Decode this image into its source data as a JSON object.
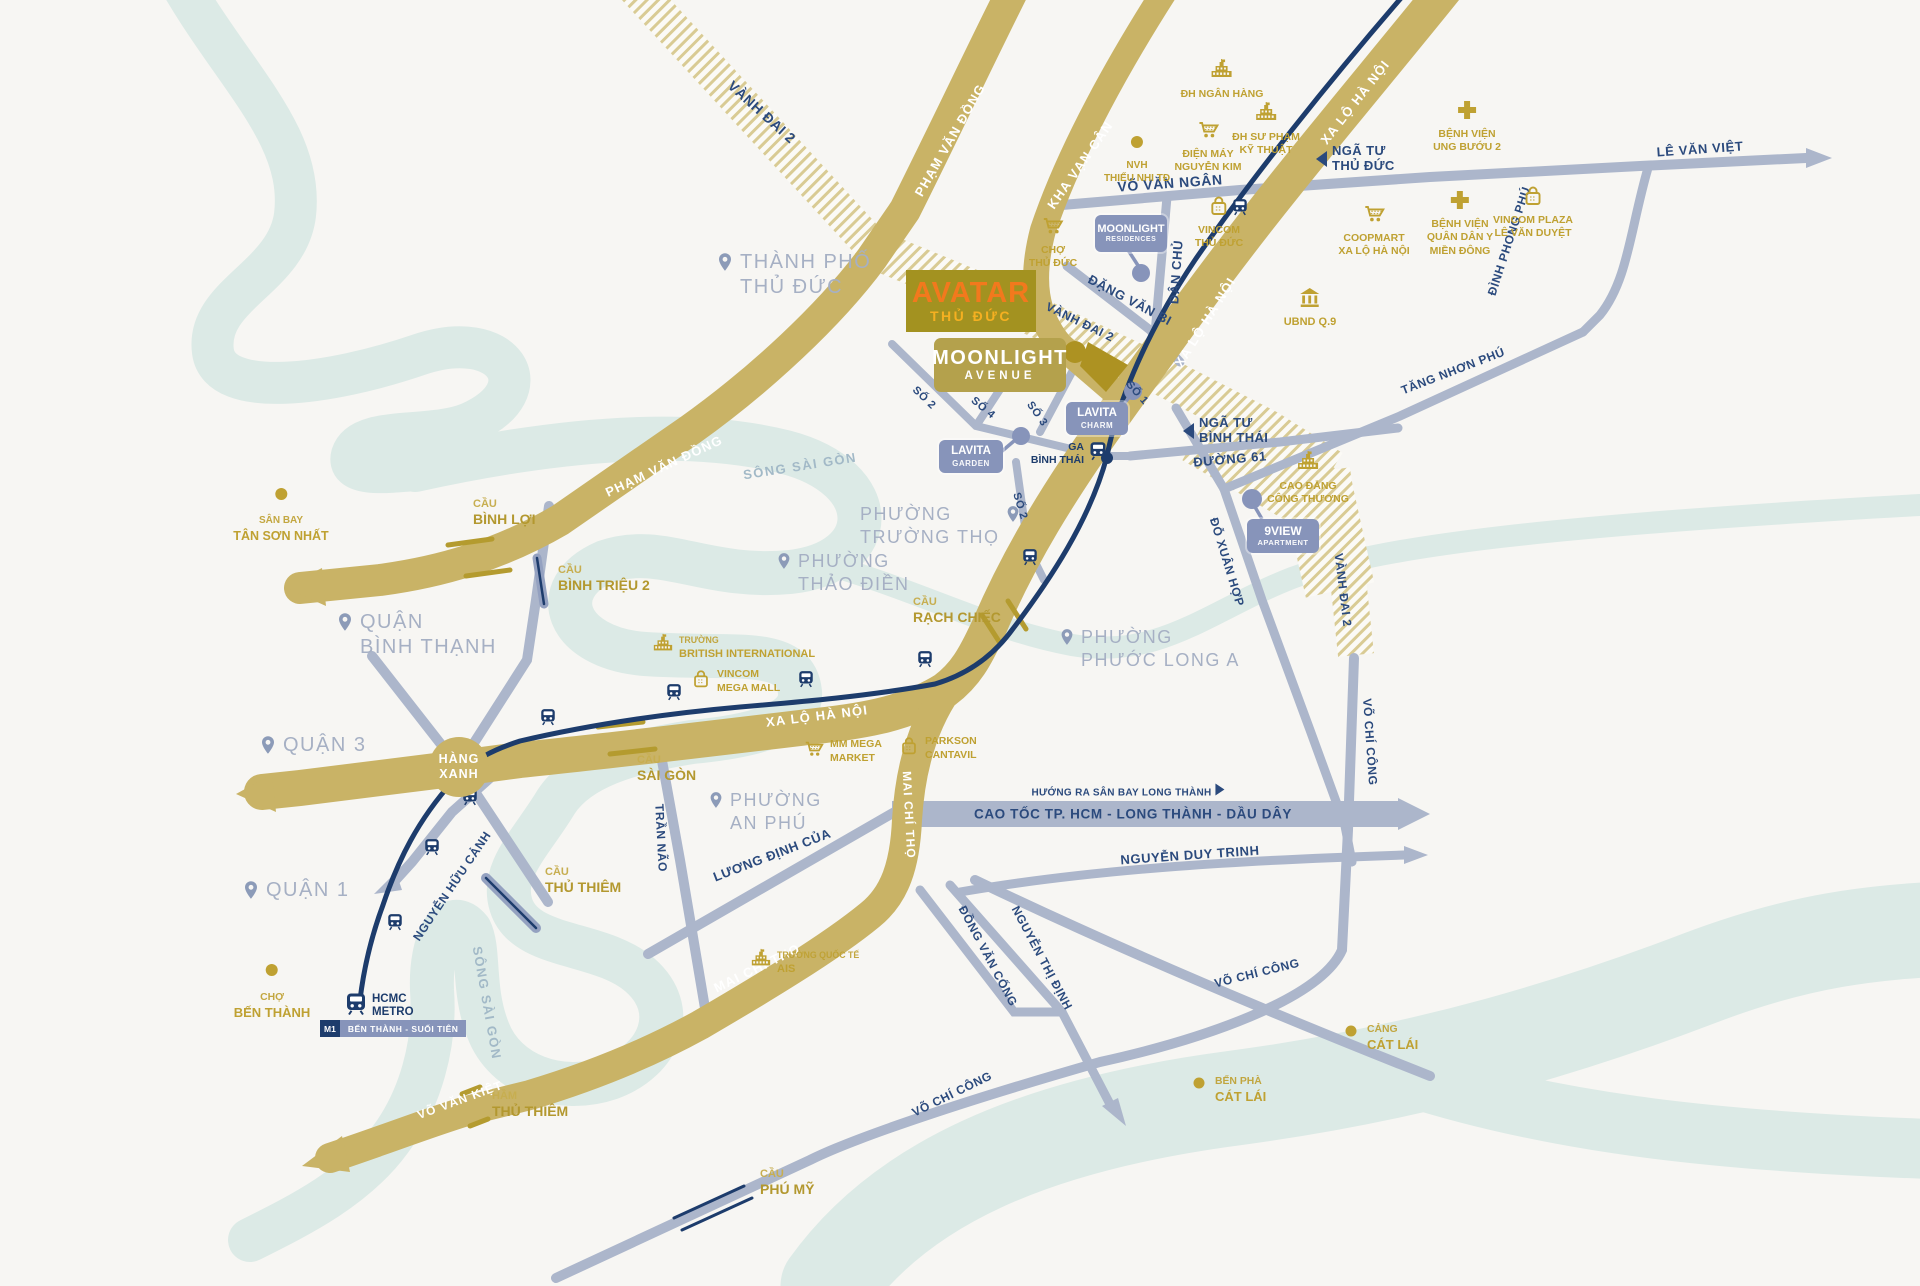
{
  "project": {
    "badge_line1": "AVATAR",
    "badge_line2": "THỦ ĐỨC",
    "avenue_line1": "MOONLIGHT",
    "avenue_line2": "AVENUE"
  },
  "hang_xanh": {
    "line1": "HÀNG",
    "line2": "XANH"
  },
  "metro": {
    "operator_line1": "HCMC",
    "operator_line2": "METRO",
    "line_badge": "M1",
    "line_name": "BẾN THÀNH - SUỐI TIÊN",
    "ga_line1": "GA",
    "ga_line2": "BÌNH THÁI"
  },
  "colors": {
    "bg": "#F7F6F3",
    "gold_road": "#C9B366",
    "gray_road": "#ACB6CB",
    "navy": "#1D3C6C",
    "street_label": "#2B4A7D",
    "river": "#DCEAE6",
    "poi_gold": "#BFA132",
    "district": "#A6B0C4",
    "pin": "#8C9BB8",
    "badge_blue": "#8794BA",
    "hatch": "#D9CB94",
    "avatar_bg": "#A39220",
    "avatar_orange": "#F2791D",
    "avatar_yellow": "#F5B021",
    "moonlight_bg": "#B4A14C"
  },
  "road_labels": [
    {
      "id": "vanh-dai-2-nw",
      "t": "VÀNH ĐAI 2",
      "x": 762,
      "y": 112,
      "r": 42,
      "s": "street",
      "fs": 14
    },
    {
      "id": "pham-van-dong-n",
      "t": "PHẠM VĂN ĐỒNG",
      "x": 950,
      "y": 140,
      "r": -60,
      "s": "onroad",
      "fs": 13
    },
    {
      "id": "kha-van-can",
      "t": "KHA VẠN CÂN",
      "x": 1080,
      "y": 165,
      "r": -55,
      "s": "onroad",
      "fs": 13
    },
    {
      "id": "xa-lo-ha-noi-n",
      "t": "XA LỘ HÀ NỘI",
      "x": 1355,
      "y": 102,
      "r": -52,
      "s": "onroad",
      "fs": 13
    },
    {
      "id": "vo-van-ngan",
      "t": "VÕ VĂN NGÂN",
      "x": 1170,
      "y": 183,
      "r": -4,
      "s": "street",
      "fs": 14
    },
    {
      "id": "le-van-viet",
      "t": "LÊ VĂN VIỆT",
      "x": 1700,
      "y": 149,
      "r": -4,
      "s": "street",
      "fs": 13
    },
    {
      "id": "dinh-phong-phu",
      "t": "ĐÌNH PHONG PHÚ",
      "x": 1509,
      "y": 241,
      "r": -72,
      "s": "street",
      "fs": 12
    },
    {
      "id": "tang-nhon-phu",
      "t": "TĂNG NHƠN PHÚ",
      "x": 1453,
      "y": 371,
      "r": -21,
      "s": "street",
      "fs": 12
    },
    {
      "id": "dang-van-bi",
      "t": "ĐẶNG VĂN BI",
      "x": 1130,
      "y": 300,
      "r": 28,
      "s": "street",
      "fs": 13
    },
    {
      "id": "dan-chu",
      "t": "DÂN CHỦ",
      "x": 1176,
      "y": 272,
      "r": -86,
      "s": "street",
      "fs": 13
    },
    {
      "id": "vanh-dai-2-c",
      "t": "VÀNH ĐAI 2",
      "x": 1080,
      "y": 322,
      "r": 26,
      "s": "street",
      "fs": 12
    },
    {
      "id": "xa-lo-ha-noi-c",
      "t": "XA LỘ HÀ NỘI",
      "x": 1205,
      "y": 322,
      "r": -58,
      "s": "onroad",
      "fs": 13
    },
    {
      "id": "so-2-a",
      "t": "SỐ 2",
      "x": 924,
      "y": 398,
      "r": 44,
      "s": "street",
      "fs": 11
    },
    {
      "id": "so-4",
      "t": "SỐ 4",
      "x": 983,
      "y": 408,
      "r": 40,
      "s": "street",
      "fs": 11
    },
    {
      "id": "so-3",
      "t": "SỐ 3",
      "x": 1037,
      "y": 414,
      "r": 55,
      "s": "street",
      "fs": 11
    },
    {
      "id": "so-1",
      "t": "SỐ 1",
      "x": 1137,
      "y": 393,
      "r": 48,
      "s": "street",
      "fs": 11
    },
    {
      "id": "so-2-b",
      "t": "SỐ 2",
      "x": 1020,
      "y": 506,
      "r": 73,
      "s": "street",
      "fs": 11
    },
    {
      "id": "duong-61",
      "t": "ĐƯỜNG 61",
      "x": 1230,
      "y": 459,
      "r": -5,
      "s": "street",
      "fs": 13
    },
    {
      "id": "do-xuan-hop",
      "t": "ĐỖ XUÂN HỢP",
      "x": 1227,
      "y": 562,
      "r": 73,
      "s": "street",
      "fs": 12
    },
    {
      "id": "vanh-dai-2-e",
      "t": "VÀNH ĐAI 2",
      "x": 1343,
      "y": 590,
      "r": 83,
      "s": "street",
      "fs": 12
    },
    {
      "id": "vo-chi-cong-v",
      "t": "VÕ CHÍ CÔNG",
      "x": 1370,
      "y": 742,
      "r": 86,
      "s": "street",
      "fs": 12
    },
    {
      "id": "tran-nao",
      "t": "TRẦN NÃO",
      "x": 661,
      "y": 838,
      "r": 87,
      "s": "street",
      "fs": 12
    },
    {
      "id": "luong-dinh-cua",
      "t": "LƯƠNG ĐỊNH CỦA",
      "x": 772,
      "y": 855,
      "r": -21,
      "s": "street",
      "fs": 13
    },
    {
      "id": "nguyen-huu-canh",
      "t": "NGUYỄN HỮU CẢNH",
      "x": 452,
      "y": 886,
      "r": -56,
      "s": "street",
      "fs": 12
    },
    {
      "id": "mai-chi-tho-v",
      "t": "MAI CHÍ THỌ",
      "x": 909,
      "y": 815,
      "r": 87,
      "s": "onroad",
      "fs": 12
    },
    {
      "id": "mai-chi-tho-sw",
      "t": "MAI CHÍ THỌ",
      "x": 757,
      "y": 968,
      "r": -26,
      "s": "onroad",
      "fs": 13
    },
    {
      "id": "xa-lo-ha-noi-s",
      "t": "XA LỘ HÀ NỘI",
      "x": 817,
      "y": 716,
      "r": -7,
      "s": "onroad",
      "fs": 13
    },
    {
      "id": "song-sai-gon-n",
      "t": "SÔNG SÀI GÒN",
      "x": 800,
      "y": 466,
      "r": -9,
      "s": "river",
      "fs": 13
    },
    {
      "id": "song-sai-gon-s",
      "t": "SÔNG SÀI GÒN",
      "x": 487,
      "y": 1003,
      "r": 80,
      "s": "river",
      "fs": 13
    },
    {
      "id": "nguyen-duy-trinh",
      "t": "NGUYỄN DUY TRINH",
      "x": 1190,
      "y": 855,
      "r": -4,
      "s": "street",
      "fs": 13
    },
    {
      "id": "nguyen-thi-dinh",
      "t": "NGUYỄN THỊ ĐỊNH",
      "x": 1042,
      "y": 958,
      "r": 62,
      "s": "street",
      "fs": 12
    },
    {
      "id": "dong-van-cong",
      "t": "ĐỒNG VĂN CỐNG",
      "x": 988,
      "y": 956,
      "r": 62,
      "s": "street",
      "fs": 12
    },
    {
      "id": "vo-chi-cong-e",
      "t": "VÕ CHÍ CÔNG",
      "x": 1257,
      "y": 973,
      "r": -14,
      "s": "street",
      "fs": 12
    },
    {
      "id": "vo-chi-cong-sw",
      "t": "VÕ CHÍ CÔNG",
      "x": 952,
      "y": 1094,
      "r": -26,
      "s": "street",
      "fs": 12
    },
    {
      "id": "vo-van-kiet",
      "t": "VÕ VĂN KIỆT",
      "x": 460,
      "y": 1100,
      "r": -20,
      "s": "onroad",
      "fs": 12
    },
    {
      "id": "pham-van-dong-w",
      "t": "PHẠM VĂN ĐỒNG",
      "x": 664,
      "y": 466,
      "r": -25,
      "s": "onroad",
      "fs": 13
    },
    {
      "id": "cao-toc",
      "t": "CAO TỐC TP. HCM - LONG THÀNH - DẦU DÂY",
      "x": 1133,
      "y": 814,
      "r": 0,
      "s": "street",
      "fs": 13.5
    }
  ],
  "direction_note": {
    "t": "HƯỚNG RA SÂN BAY LONG THÀNH",
    "x": 1128,
    "y": 791
  },
  "junctions": [
    {
      "id": "nga-tu-thu-duc",
      "lines": [
        "NGÃ TƯ",
        "THỦ ĐỨC"
      ],
      "x": 1316,
      "y": 160
    },
    {
      "id": "nga-tu-binh-thai",
      "lines": [
        "NGÃ TƯ",
        "BÌNH THÁI"
      ],
      "x": 1183,
      "y": 432
    }
  ],
  "districts": [
    {
      "id": "tp-thu-duc",
      "lines": [
        "THÀNH PHỐ",
        "THỦ ĐỨC"
      ],
      "x": 715,
      "y": 250,
      "fs": 20
    },
    {
      "id": "quan-binh-thanh",
      "lines": [
        "QUẬN",
        "BÌNH THẠNH"
      ],
      "x": 335,
      "y": 610,
      "fs": 20
    },
    {
      "id": "quan-3",
      "lines": [
        "QUẬN 3"
      ],
      "x": 258,
      "y": 733,
      "fs": 20
    },
    {
      "id": "quan-1",
      "lines": [
        "QUẬN 1"
      ],
      "x": 241,
      "y": 878,
      "fs": 20
    },
    {
      "id": "phuong-truong-tho",
      "lines": [
        "PHƯỜNG",
        "TRƯỜNG THỌ"
      ],
      "x": 860,
      "y": 503,
      "fs": 18,
      "pinSide": "right"
    },
    {
      "id": "phuong-thao-dien",
      "lines": [
        "PHƯỜNG",
        "THẢO ĐIỀN"
      ],
      "x": 775,
      "y": 550,
      "fs": 18
    },
    {
      "id": "phuong-phuoc-long-a",
      "lines": [
        "PHƯỜNG",
        "PHƯỚC LONG A"
      ],
      "x": 1058,
      "y": 626,
      "fs": 18
    },
    {
      "id": "phuong-an-phu",
      "lines": [
        "PHƯỜNG",
        "AN PHÚ"
      ],
      "x": 707,
      "y": 789,
      "fs": 18
    }
  ],
  "pois": [
    {
      "id": "dh-ngan-hang",
      "icon": "school",
      "layout": "top",
      "x": 1222,
      "y": 58,
      "lines": [
        "ĐH NGÂN HÀNG"
      ],
      "fs": 10.5
    },
    {
      "id": "nvh-thieu-nhi",
      "icon": "dot",
      "layout": "top",
      "x": 1137,
      "y": 130,
      "lines": [
        "NVH",
        "THIẾU NHI TĐ"
      ],
      "fs": 10
    },
    {
      "id": "dien-may-nguyen-kim",
      "icon": "cart",
      "layout": "top",
      "x": 1208,
      "y": 118,
      "lines": [
        "ĐIỆN MÁY",
        "NGUYỄN KIM"
      ],
      "fs": 10.5
    },
    {
      "id": "dh-su-pham-ky-thuat",
      "icon": "school",
      "layout": "top",
      "x": 1266,
      "y": 101,
      "lines": [
        "ĐH SƯ PHẠM",
        "KỸ THUẬT"
      ],
      "fs": 10.5
    },
    {
      "id": "bv-ung-buou-2",
      "icon": "cross",
      "layout": "top",
      "x": 1467,
      "y": 98,
      "lines": [
        "BỆNH VIỆN",
        "UNG BƯỚU 2"
      ],
      "fs": 10.5
    },
    {
      "id": "cho-thu-duc",
      "icon": "cart",
      "layout": "top",
      "x": 1053,
      "y": 214,
      "lines": [
        "CHỢ",
        "THỦ ĐỨC"
      ],
      "fs": 10.5
    },
    {
      "id": "vincom-thu-duc",
      "icon": "bag",
      "layout": "top",
      "x": 1219,
      "y": 194,
      "lines": [
        "VINCOM",
        "THỦ ĐỨC"
      ],
      "fs": 10.5
    },
    {
      "id": "coopmart-xlhn",
      "icon": "cart",
      "layout": "top",
      "x": 1374,
      "y": 202,
      "lines": [
        "COOPMART",
        "XA LỘ HÀ NỘI"
      ],
      "fs": 10.5
    },
    {
      "id": "bv-quan-dan-y",
      "icon": "cross",
      "layout": "top",
      "x": 1460,
      "y": 188,
      "lines": [
        "BỆNH VIỆN",
        "QUÂN DÂN Y",
        "MIỀN ĐÔNG"
      ],
      "fs": 10.5
    },
    {
      "id": "vincom-plaza-lvd",
      "icon": "bag",
      "layout": "top",
      "x": 1533,
      "y": 184,
      "lines": [
        "VINCOM PLAZA",
        "LÊ VĂN DUYỆT"
      ],
      "fs": 10.5
    },
    {
      "id": "ubnd-q9",
      "icon": "bank",
      "layout": "top",
      "x": 1310,
      "y": 286,
      "lines": [
        "UBND Q.9"
      ],
      "fs": 11
    },
    {
      "id": "cao-dang-cong-thuong",
      "icon": "school",
      "layout": "top",
      "x": 1308,
      "y": 450,
      "lines": [
        "CAO ĐẲNG",
        "CÔNG THƯƠNG"
      ],
      "fs": 10.5
    },
    {
      "id": "truong-british-international",
      "icon": "school",
      "layout": "left",
      "x": 652,
      "y": 633,
      "lines": [
        "TRƯỜNG",
        "BRITISH INTERNATIONAL"
      ],
      "fs": 11,
      "smallFirst": true
    },
    {
      "id": "vincom-mega-mall",
      "icon": "bag",
      "layout": "left",
      "x": 690,
      "y": 668,
      "lines": [
        "VINCOM",
        "MEGA MALL"
      ],
      "fs": 10.5
    },
    {
      "id": "mm-mega-market",
      "icon": "cart",
      "layout": "left",
      "x": 803,
      "y": 738,
      "lines": [
        "MM MEGA",
        "MARKET"
      ],
      "fs": 10.5
    },
    {
      "id": "parkson-cantavil",
      "icon": "bag",
      "layout": "left",
      "x": 898,
      "y": 735,
      "lines": [
        "PARKSON",
        "CANTAVIL"
      ],
      "fs": 10.5
    },
    {
      "id": "truong-quoc-te-ais",
      "icon": "school",
      "layout": "left",
      "x": 750,
      "y": 948,
      "lines": [
        "TRƯỜNG QUỐC TẾ",
        "AIS"
      ],
      "fs": 11,
      "smallFirst": true
    },
    {
      "id": "san-bay-tan-son-nhat",
      "icon": "dot",
      "layout": "top",
      "x": 281,
      "y": 482,
      "lines": [
        "SÂN BAY",
        "TÂN SƠN NHẤT"
      ],
      "fs": 12.5,
      "smallFirst": true
    },
    {
      "id": "cho-ben-thanh",
      "icon": "dot",
      "layout": "top",
      "x": 272,
      "y": 958,
      "lines": [
        "CHỢ",
        "BẾN THÀNH"
      ],
      "fs": 13,
      "smallFirst": true
    },
    {
      "id": "cang-cat-lai",
      "icon": "dot",
      "layout": "left",
      "x": 1340,
      "y": 1020,
      "lines": [
        "CẢNG",
        "CÁT LÁI"
      ],
      "fs": 13,
      "smallFirst": true
    },
    {
      "id": "ben-pha-cat-lai",
      "icon": "dot",
      "layout": "left",
      "x": 1188,
      "y": 1072,
      "lines": [
        "BẾN PHÀ",
        "CÁT LÁI"
      ],
      "fs": 13,
      "smallFirst": true
    }
  ],
  "bridges": [
    {
      "id": "cau-binh-loi",
      "l1": "CẦU",
      "l2": "BÌNH LỢI",
      "x": 473,
      "y": 498
    },
    {
      "id": "cau-binh-trieu-2",
      "l1": "CẦU",
      "l2": "BÌNH TRIỆU 2",
      "x": 558,
      "y": 564
    },
    {
      "id": "cau-sai-gon",
      "l1": "CẦU",
      "l2": "SÀI GÒN",
      "x": 637,
      "y": 754
    },
    {
      "id": "cau-rach-chiec",
      "l1": "CẦU",
      "l2": "RẠCH CHIẾC",
      "x": 913,
      "y": 596
    },
    {
      "id": "cau-thu-thiem",
      "l1": "CẦU",
      "l2": "THỦ THIÊM",
      "x": 545,
      "y": 866
    },
    {
      "id": "ham-thu-thiem",
      "l1": "HẦM",
      "l2": "THỦ THIÊM",
      "x": 492,
      "y": 1090
    },
    {
      "id": "cau-phu-my",
      "l1": "CẦU",
      "l2": "PHÚ MỸ",
      "x": 760,
      "y": 1168
    }
  ],
  "residences": [
    {
      "id": "moonlight-residences",
      "l1": "MOONLIGHT",
      "l2": "RESIDENCES",
      "x": 1095,
      "y": 215,
      "w": 72,
      "h": 37,
      "fs1": 11,
      "fs2": 7
    },
    {
      "id": "lavita-charm",
      "l1": "LAVITA",
      "l2": "CHARM",
      "x": 1066,
      "y": 402,
      "w": 62,
      "h": 33,
      "fs1": 11.5,
      "fs2": 8
    },
    {
      "id": "lavita-garden",
      "l1": "LAVITA",
      "l2": "GARDEN",
      "x": 939,
      "y": 440,
      "w": 64,
      "h": 33,
      "fs1": 11.5,
      "fs2": 8
    },
    {
      "id": "9view-apartment",
      "l1": "9VIEW",
      "l2": "APARTMENT",
      "x": 1247,
      "y": 519,
      "w": 72,
      "h": 34,
      "fs1": 12,
      "fs2": 7.5
    }
  ],
  "stations": [
    [
      1240,
      208
    ],
    [
      1030,
      558
    ],
    [
      925,
      660
    ],
    [
      806,
      680
    ],
    [
      674,
      693
    ],
    [
      548,
      718
    ],
    [
      470,
      798
    ],
    [
      432,
      848
    ],
    [
      395,
      923
    ]
  ]
}
